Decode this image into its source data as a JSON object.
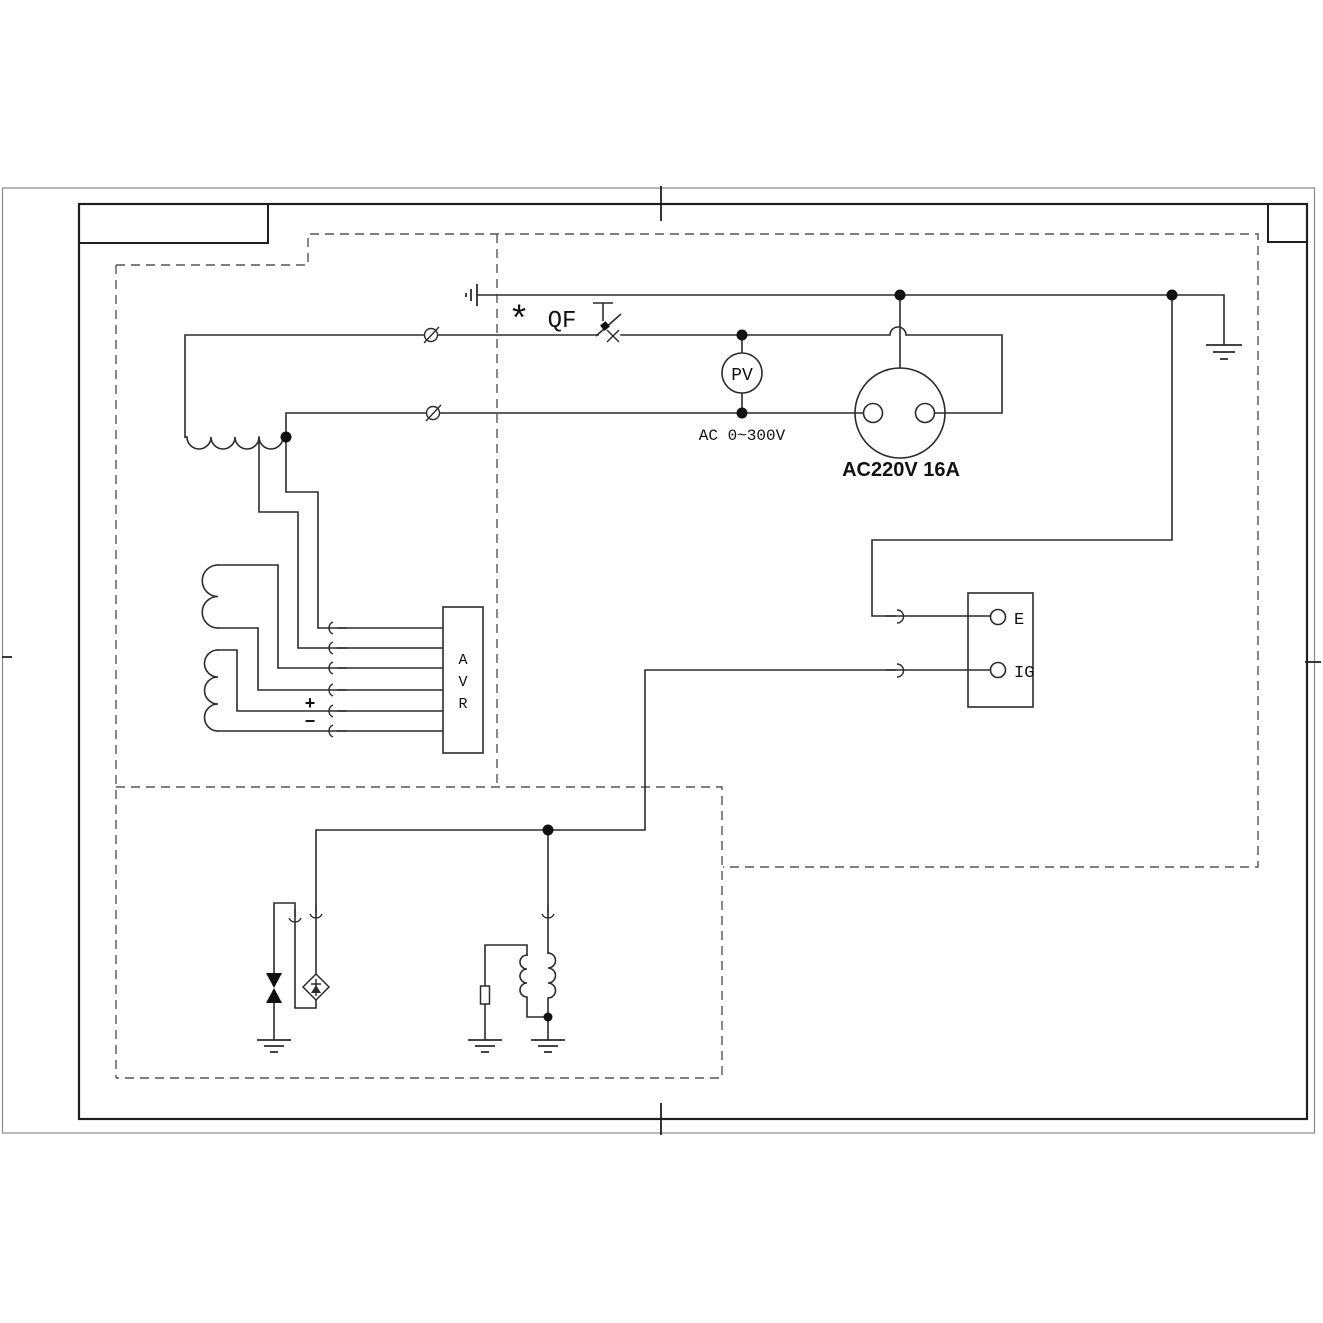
{
  "diagram": {
    "type": "electrical-wiring-schematic",
    "labels": {
      "breaker_mark": "*",
      "breaker": "QF",
      "voltmeter": "PV",
      "voltmeter_range": "AC 0~300V",
      "socket_rating": "AC220V 16A",
      "avr_letters": [
        "A",
        "V",
        "R"
      ],
      "polarity_plus": "+",
      "polarity_minus": "−",
      "terminal_e": "E",
      "terminal_ig": "IG"
    },
    "colors": {
      "line": "#2b2b2b",
      "dashed_outline": "#555555",
      "frame": "#1f1f1f",
      "background": "#ffffff"
    }
  }
}
